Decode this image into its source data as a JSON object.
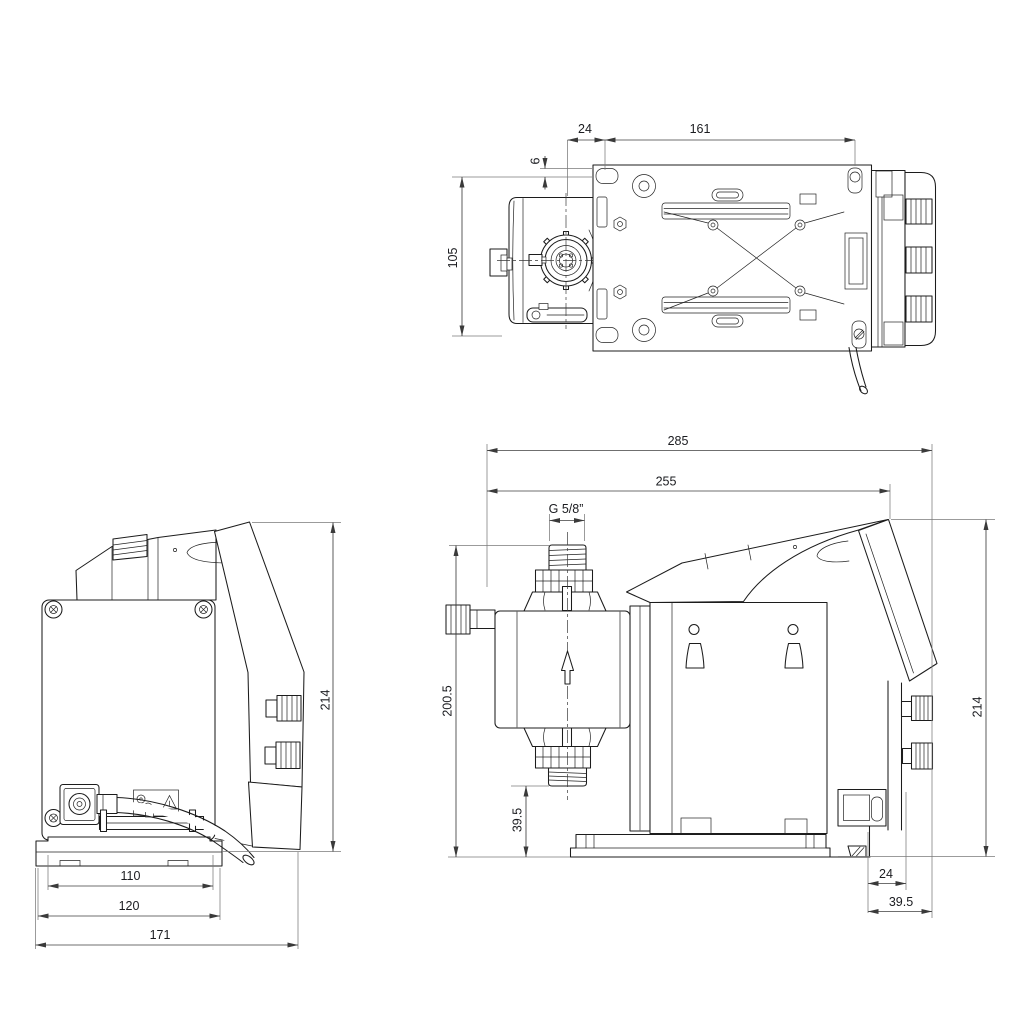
{
  "views": {
    "top": {
      "dims": {
        "offset_24": "24",
        "span_161": "161",
        "offset_6": "6",
        "pitch_105": "105"
      }
    },
    "back": {
      "dims": {
        "height_214": "214",
        "base_110": "110",
        "base_120": "120",
        "width_171": "171"
      }
    },
    "side": {
      "dims": {
        "length_285": "285",
        "length_255": "255",
        "thread": "G 5/8”",
        "height_200_5": "200.5",
        "inlet_39_5": "39.5",
        "height_214": "214",
        "rear_24": "24",
        "rear_39_5": "39.5"
      }
    }
  },
  "colors": {
    "outline": "#1c1c1c",
    "dimension_line": "#3f3f3f",
    "extension_line": "#7b7b7b",
    "background": "#ffffff"
  }
}
